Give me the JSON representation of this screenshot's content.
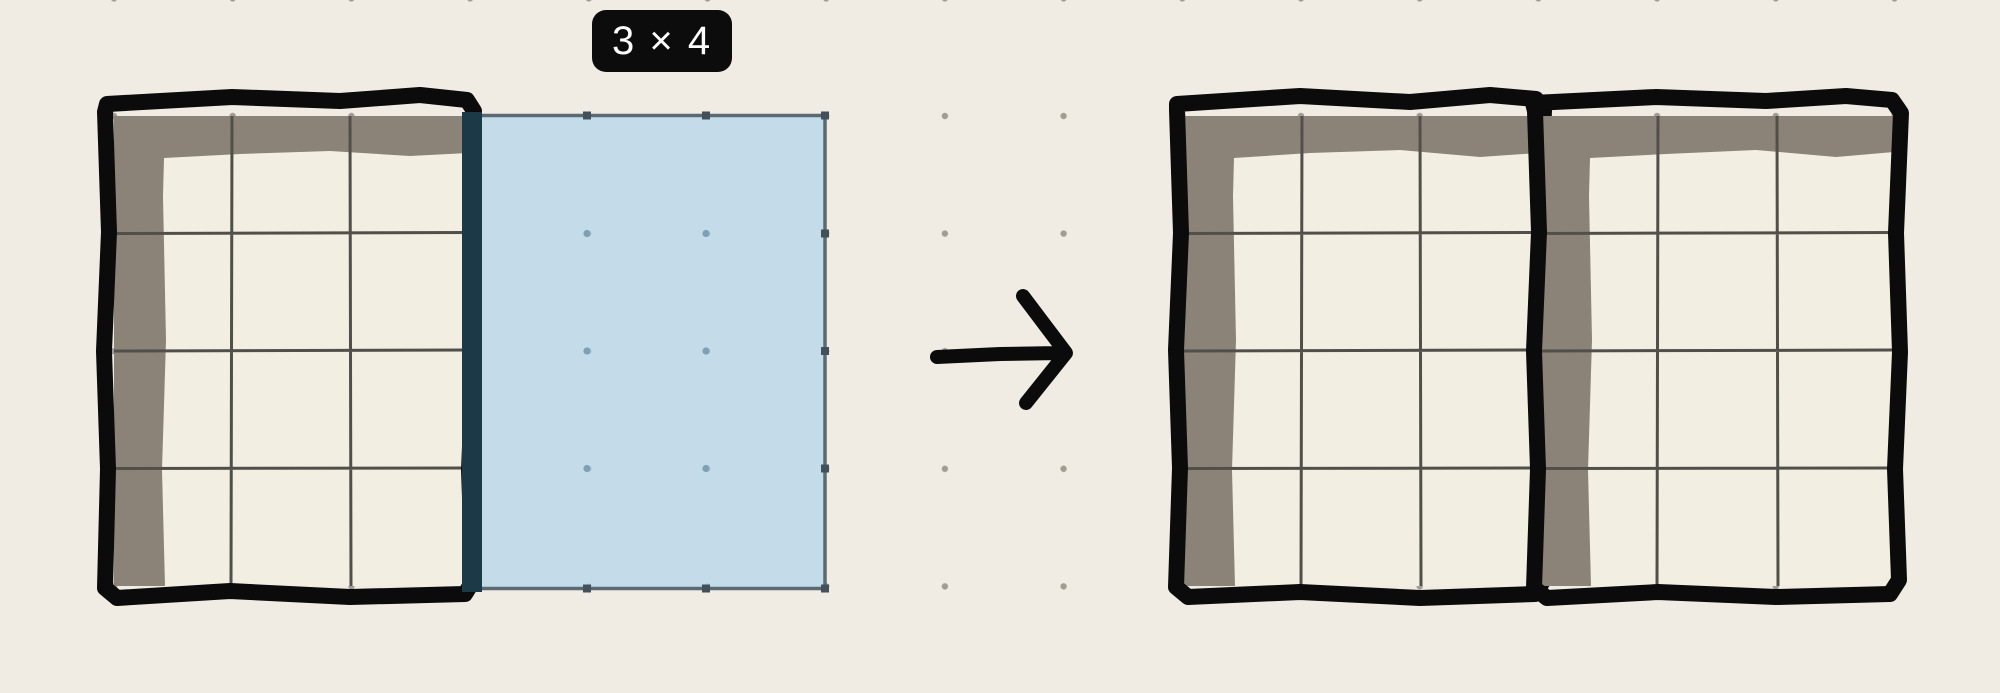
{
  "size_label": {
    "text": "3 × 4"
  },
  "scene": {
    "source_table": {
      "columns": 3,
      "rows": 4
    },
    "preview_rect": {
      "columns": 3,
      "rows": 4
    },
    "result_table_1": {
      "columns": 3,
      "rows": 4
    },
    "result_table_2": {
      "columns": 3,
      "rows": 4
    }
  },
  "colors": {
    "bg": "#f0ebe3",
    "dot": "#a29c92",
    "ink": "#0b0b0b",
    "shade": "#8c8378",
    "paper": "#f2efe2",
    "grid_line": "#514f4a",
    "preview_fill": "#b9d8ea",
    "preview_stroke": "#5a6a74",
    "overlap": "#1b3947",
    "nub": "#42505a",
    "through_dot": "#7da0b5",
    "label_bg": "#0c0c0c",
    "label_text": "#ffffff"
  }
}
